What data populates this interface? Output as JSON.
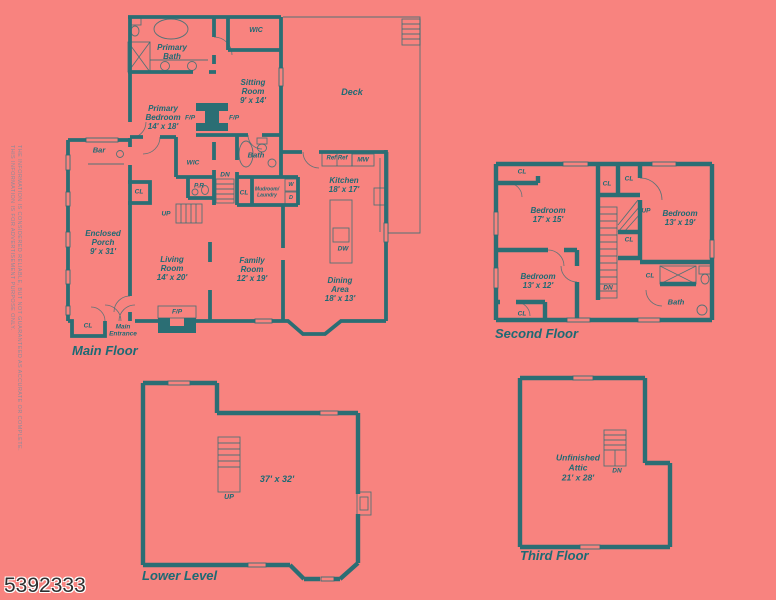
{
  "page": {
    "background_color": "#f8837f",
    "wall_color": "#2b6e74",
    "label_color": "#1d6a74",
    "photo_id": "5392333",
    "disclaimer_line1": "THIS INFORMATION IS FOR ADVERTISEMENT PURPOSE ONLY.",
    "disclaimer_line2": "THE INFORMATION IS CONSIDERED RELIABLE, BUT NOT GUARANTEED AS ACCURATE OR COMPLETE."
  },
  "floors": {
    "main": {
      "title": "Main Floor",
      "labels": {
        "primary_bath": "Primary\nBath",
        "wic_top": "WIC",
        "sitting_room": "Sitting\nRoom\n9' x 14'",
        "deck": "Deck",
        "primary_bedroom": "Primary\nBedroom\n14' x 18'",
        "fp_left": "F/P",
        "fp_right": "F/P",
        "bar": "Bar",
        "bath": "Bath",
        "wic": "WIC",
        "dn": "DN",
        "pr": "P.R",
        "cl_hall": "CL",
        "mudroom": "Mudroom/\nLaundry",
        "washer": "W",
        "dryer": "D",
        "ref": "Ref Ref",
        "mw": "MW",
        "kitchen": "Kitchen\n18' x 17'",
        "cl_bar": "CL",
        "up": "UP",
        "dw": "DW",
        "enclosed_porch": "Enclosed\nPorch\n9' x 31'",
        "living_room": "Living\nRoom\n14' x 20'",
        "family_room": "Family\nRoom\n12' x 19'",
        "dining_area": "Dining\nArea\n18' x 13'",
        "cl_entry": "CL",
        "main_entrance": "Main\nEntrance",
        "fp_bottom": "F/P"
      }
    },
    "second": {
      "title": "Second Floor",
      "labels": {
        "cl_tl": "CL",
        "bedroom_1": "Bedroom\n17' x 15'",
        "cl_a": "CL",
        "cl_b": "CL",
        "up": "UP",
        "bedroom_2": "Bedroom\n13' x 19'",
        "cl_c": "CL",
        "bedroom_3": "Bedroom\n13' x 12'",
        "dn": "DN",
        "cl_d": "CL",
        "cl_bl": "CL",
        "bath": "Bath"
      }
    },
    "lower": {
      "title": "Lower Level",
      "labels": {
        "dims": "37' x 32'",
        "up": "UP"
      }
    },
    "third": {
      "title": "Third Floor",
      "labels": {
        "attic": "Unfinished\nAttic\n21' x 28'",
        "dn": "DN"
      }
    }
  }
}
